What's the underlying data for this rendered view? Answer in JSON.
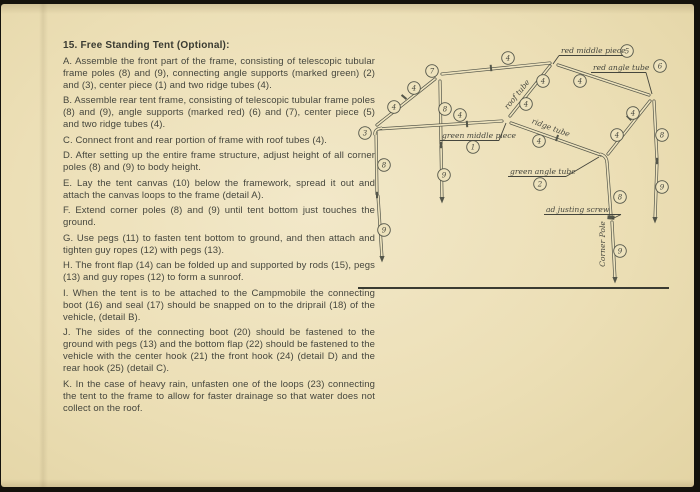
{
  "page": {
    "heading": "15. Free Standing Tent (Optional):",
    "instructions": [
      {
        "letter": "A",
        "text": "Assemble the front part of the frame, consisting of telescopic tubular frame poles (8) and (9), connecting angle supports (marked green) (2) and (3), center piece (1) and two ridge tubes (4)."
      },
      {
        "letter": "B",
        "text": "Assemble rear tent frame, consisting of telescopic tubular frame poles (8) and (9), angle supports (marked red) (6) and (7), center piece (5) and two ridge tubes (4)."
      },
      {
        "letter": "C",
        "text": "Connect front and rear portion of frame with roof tubes (4)."
      },
      {
        "letter": "D",
        "text": "After setting up the entire frame structure, adjust height of all corner poles (8) and (9) to body height."
      },
      {
        "letter": "E",
        "text": "Lay the tent canvas (10) below the framework, spread it out and attach the canvas loops to the frame (detail A)."
      },
      {
        "letter": "F",
        "text": "Extend corner poles (8) and (9) until tent bottom just touches the ground."
      },
      {
        "letter": "G",
        "text": "Use pegs (11) to fasten tent bottom to ground, and then attach and tighten guy ropes (12) with pegs (13)."
      },
      {
        "letter": "H",
        "text": "The front flap (14) can be folded up and supported by rods (15), pegs (13) and guy ropes (12) to form a sunroof."
      },
      {
        "letter": "I",
        "text": "When the tent is to be attached to the Campmobile the connecting boot (16) and seal (17) should be snapped on to the driprail (18) of the vehicle, (detail B)."
      },
      {
        "letter": "J",
        "text": "The sides of the connecting boot (20) should be fastened to the ground with pegs (13) and the bottom flap (22) should be fastened to the vehicle with the center hook (21) the front hook (24) (detail D) and the rear hook (25) (detail C)."
      },
      {
        "letter": "K",
        "text": "In the case of heavy rain, unfasten one of the loops (23) connecting the tent to the frame to allow for faster drainage so that water does not collect on the roof."
      }
    ]
  },
  "diagram": {
    "callouts": [
      {
        "n": "3",
        "x": 364,
        "y": 129
      },
      {
        "n": "7",
        "x": 431,
        "y": 67
      },
      {
        "n": "4",
        "x": 393,
        "y": 103
      },
      {
        "n": "4",
        "x": 413,
        "y": 84
      },
      {
        "n": "8",
        "x": 444,
        "y": 105
      },
      {
        "n": "9",
        "x": 443,
        "y": 171
      },
      {
        "n": "4",
        "x": 459,
        "y": 111
      },
      {
        "n": "1",
        "x": 472,
        "y": 143
      },
      {
        "n": "4",
        "x": 507,
        "y": 54
      },
      {
        "n": "4",
        "x": 525,
        "y": 100
      },
      {
        "n": "4",
        "x": 542,
        "y": 77
      },
      {
        "n": "5",
        "x": 626,
        "y": 47
      },
      {
        "n": "4",
        "x": 579,
        "y": 77
      },
      {
        "n": "6",
        "x": 659,
        "y": 62
      },
      {
        "n": "4",
        "x": 616,
        "y": 131
      },
      {
        "n": "4",
        "x": 632,
        "y": 109
      },
      {
        "n": "4",
        "x": 538,
        "y": 137
      },
      {
        "n": "2",
        "x": 539,
        "y": 180
      },
      {
        "n": "8",
        "x": 383,
        "y": 161
      },
      {
        "n": "9",
        "x": 383,
        "y": 226
      },
      {
        "n": "8",
        "x": 661,
        "y": 131
      },
      {
        "n": "9",
        "x": 661,
        "y": 183
      },
      {
        "n": "8",
        "x": 619,
        "y": 193
      },
      {
        "n": "9",
        "x": 619,
        "y": 247
      }
    ],
    "labels": [
      {
        "id": "red-middle-piece-label",
        "text": "red middle piece",
        "x": 560,
        "y": 49,
        "anchor": "start",
        "rotate": 0,
        "underline": [
          558,
          51.5,
          622,
          51.5
        ],
        "leader": [
          558,
          51.5,
          552,
          60
        ]
      },
      {
        "id": "red-angle-tube-label",
        "text": "red angle tube",
        "x": 592,
        "y": 66,
        "anchor": "start",
        "rotate": 0,
        "underline": [
          590,
          68.5,
          645,
          68.5
        ],
        "leader": [
          645,
          68.5,
          651,
          90
        ]
      },
      {
        "id": "roof-tube-label",
        "text": "roof tube",
        "x": 518,
        "y": 92,
        "anchor": "middle",
        "rotate": -51,
        "underline": null,
        "leader": null
      },
      {
        "id": "ridge-tube-label",
        "text": "ridge tube",
        "x": 549,
        "y": 126,
        "anchor": "middle",
        "rotate": 20,
        "underline": null,
        "leader": null
      },
      {
        "id": "green-middle-piece-label",
        "text": "green middle piece",
        "x": 441,
        "y": 134,
        "anchor": "start",
        "rotate": 0,
        "underline": [
          439,
          136.5,
          498,
          136.5
        ],
        "leader": [
          498,
          136.5,
          505,
          119
        ]
      },
      {
        "id": "green-angle-tube-label",
        "text": "green angle tube",
        "x": 509,
        "y": 170,
        "anchor": "start",
        "rotate": 0,
        "underline": [
          507,
          172.5,
          565,
          172.5
        ],
        "leader": [
          565,
          172.5,
          598,
          153
        ]
      },
      {
        "id": "adjusting-screw-label",
        "text": "ad justing screw",
        "x": 545,
        "y": 208,
        "anchor": "start",
        "rotate": 0,
        "underline": [
          543,
          210.5,
          620,
          210.5
        ],
        "leader": [
          620,
          210.5,
          611,
          215
        ]
      },
      {
        "id": "corner-pole-label",
        "text": "Corner Pole",
        "x": 604,
        "y": 240,
        "anchor": "middle",
        "rotate": -90,
        "underline": null,
        "leader": null
      }
    ]
  },
  "colors": {
    "paper": "#ecdfb6",
    "ink": "#45463d",
    "line": "#54564a",
    "background": "#14120c"
  }
}
